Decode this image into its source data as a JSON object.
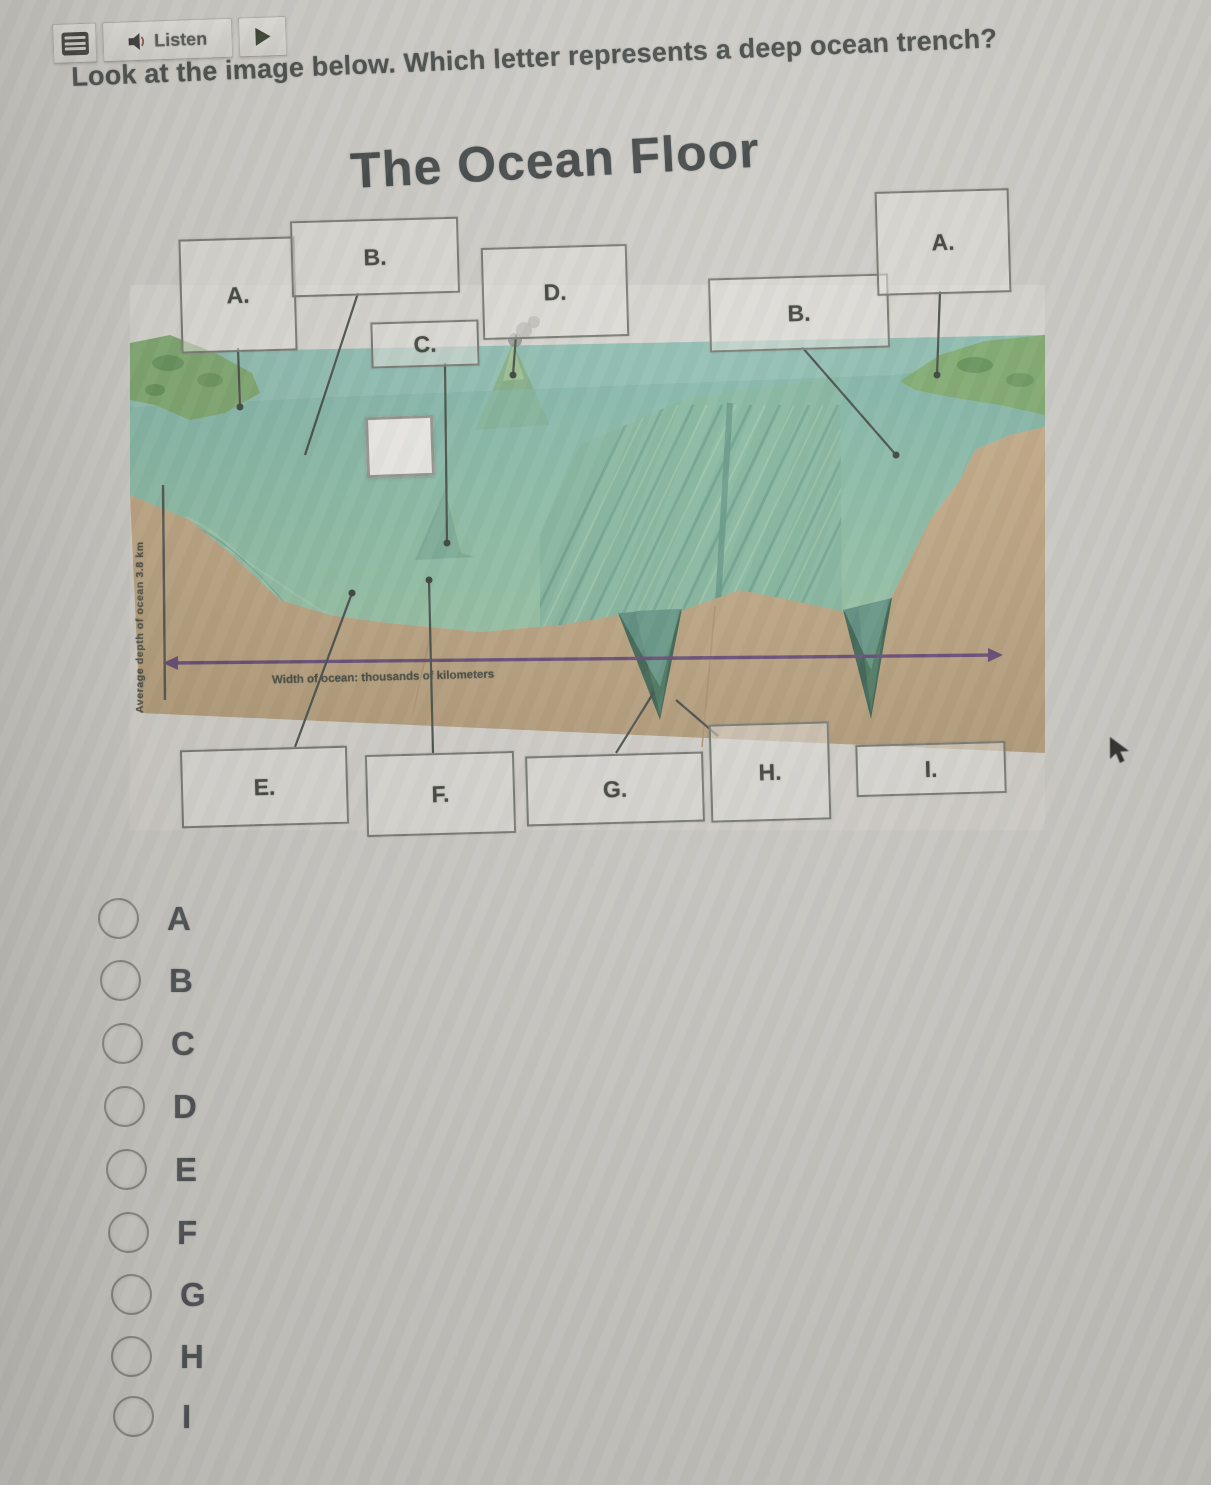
{
  "toolbar": {
    "listen_label": "Listen",
    "icons": {
      "menu": "hamburger-icon",
      "listen": "speaker-icon",
      "advance": "play-icon"
    }
  },
  "question": {
    "text": "Look at the image below. Which letter represents a deep ocean trench?"
  },
  "diagram": {
    "title": "The Ocean Floor",
    "x_axis_caption": "Width of ocean: thousands of kilometers",
    "y_axis_caption": "Average depth of ocean 3.8 km",
    "top_boxes": [
      {
        "label": "A."
      },
      {
        "label": "B."
      },
      {
        "label": "C."
      },
      {
        "label": "D."
      }
    ],
    "right_boxes": [
      {
        "label": "B."
      },
      {
        "label": "A."
      }
    ],
    "bottom_boxes": [
      {
        "label": "E."
      },
      {
        "label": "F."
      },
      {
        "label": "G."
      },
      {
        "label": "H."
      },
      {
        "label": "I."
      }
    ],
    "colors": {
      "water_teal": "#8cc0b3",
      "seafloor_green": "#8fbf9a",
      "sediment_brown": "#c0a47c",
      "trench_dark": "#2f5b48",
      "arrow_purple": "#5e3f70",
      "land_green": "#79a768"
    }
  },
  "options": [
    {
      "label": "A"
    },
    {
      "label": "B"
    },
    {
      "label": "C"
    },
    {
      "label": "D"
    },
    {
      "label": "E"
    },
    {
      "label": "F"
    },
    {
      "label": "G"
    },
    {
      "label": "H"
    },
    {
      "label": "I"
    }
  ],
  "cursor_icon": "mouse-cursor-icon"
}
